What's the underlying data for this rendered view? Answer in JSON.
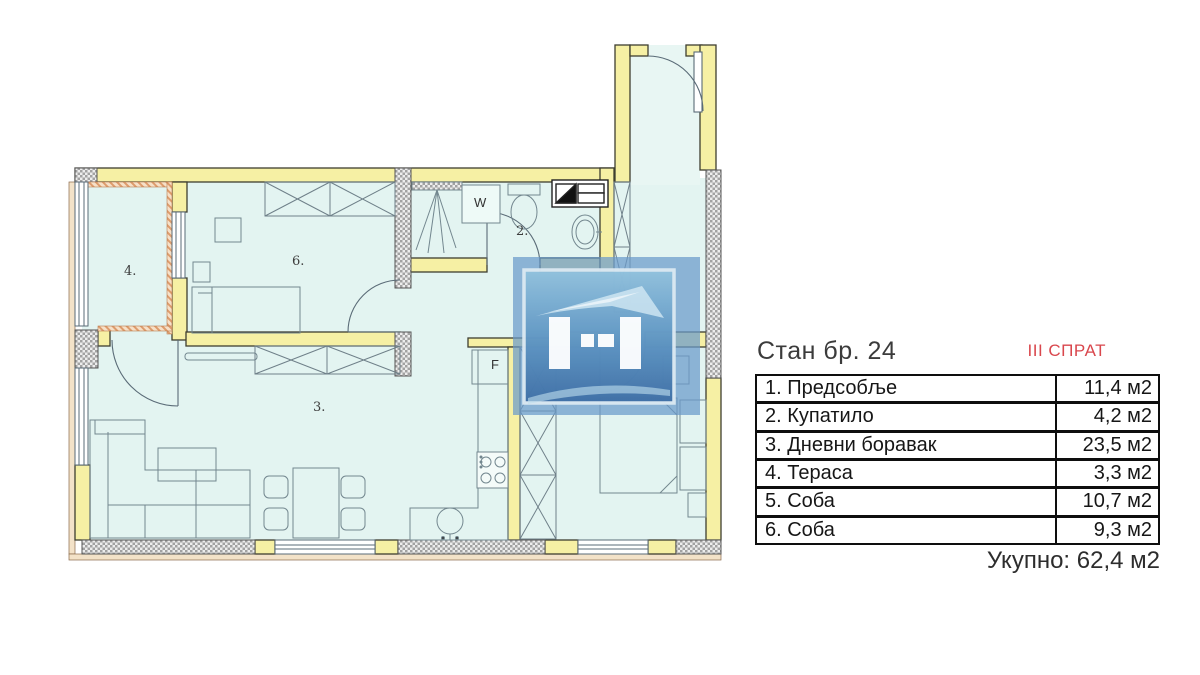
{
  "header": {
    "apartment_title": "Стан бр. 24",
    "floor_label": "III СПРАТ"
  },
  "area_table": {
    "rows": [
      {
        "label": "1. Предсобље",
        "area": "11,4 м2"
      },
      {
        "label": "2. Купатило",
        "area": "4,2 м2"
      },
      {
        "label": "3. Дневни боравак",
        "area": "23,5 м2"
      },
      {
        "label": "4. Тераса",
        "area": "3,3 м2"
      },
      {
        "label": "5. Соба",
        "area": "10,7 м2"
      },
      {
        "label": "6. Соба",
        "area": "9,3 м2"
      }
    ],
    "total": "Укупно: 62,4 м2"
  },
  "plan_labels": {
    "room2": "2.",
    "room3": "3.",
    "room4": "4.",
    "room6": "6.",
    "washer": "W",
    "fridge": "F"
  },
  "colors": {
    "wall_yellow": "#f6f0a4",
    "room_fill": "#e3f4f1",
    "floor_accent_red": "#d9474d",
    "watermark_blue": "#5d8fbe"
  }
}
